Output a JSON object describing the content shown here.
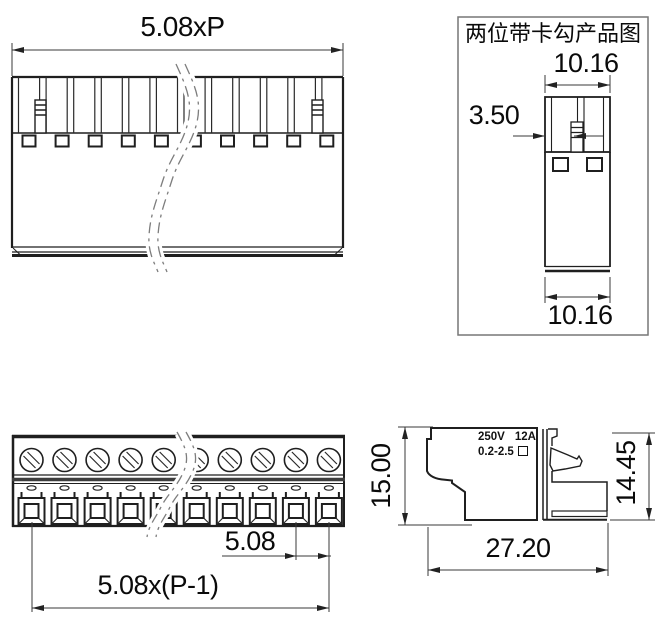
{
  "meta": {
    "background": "#ffffff",
    "line_color": "#1f1f1f",
    "dim_line_color": "#3a3a3a"
  },
  "top_view": {
    "width_dim": "5.08xP"
  },
  "panel": {
    "title": "两位带卡勾产品图",
    "top_width_dim": "10.16",
    "latch_offset_dim": "3.50",
    "bottom_width_dim": "10.16"
  },
  "front_view": {
    "pitch_dim": "5.08",
    "span_dim": "5.08x(P-1)"
  },
  "side_view": {
    "height_dim": "15.00",
    "rear_height_dim": "14.45",
    "depth_dim": "27.20",
    "marking": {
      "voltage": "250V",
      "current": "12A",
      "wire_range": "0.2-2.5"
    }
  }
}
